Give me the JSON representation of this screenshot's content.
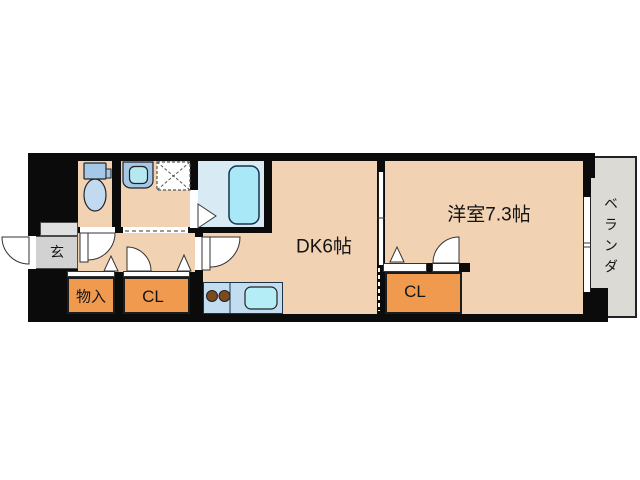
{
  "title": "1DK apartment floor plan",
  "rooms": {
    "entrance": {
      "label": "玄"
    },
    "storage": {
      "label": "物入"
    },
    "hall_closet": {
      "label": "CL"
    },
    "dining_kitchen": {
      "label": "DK6帖"
    },
    "bedroom": {
      "label": "洋室7.3帖"
    },
    "bedroom_closet": {
      "label": "CL"
    },
    "veranda": {
      "label": "ベランダ"
    }
  },
  "fixtures": [
    "toilet-icon",
    "vanity-sink-icon",
    "washer-pan-icon",
    "bathtub-icon",
    "stove-burners-icon",
    "kitchen-sink-icon",
    "swing-door-icon",
    "folding-door-icon",
    "sliding-door-icon",
    "window-icon"
  ],
  "colors": {
    "wall": "#0b0b0b",
    "floor_tan": "#f1d2b2",
    "closet_orange": "#f09a50",
    "bath_floor": "#d8ebf5",
    "bathtub": "#a9e9f7",
    "fixture_blue": "#a6c8e8",
    "kitchen_counter": "#c2ddef",
    "kitchen_sink": "#b4edf5",
    "burner_brown": "#7b4a1f",
    "entrance_gray": "#d2d2d2",
    "veranda_gray": "#dcdad5"
  }
}
